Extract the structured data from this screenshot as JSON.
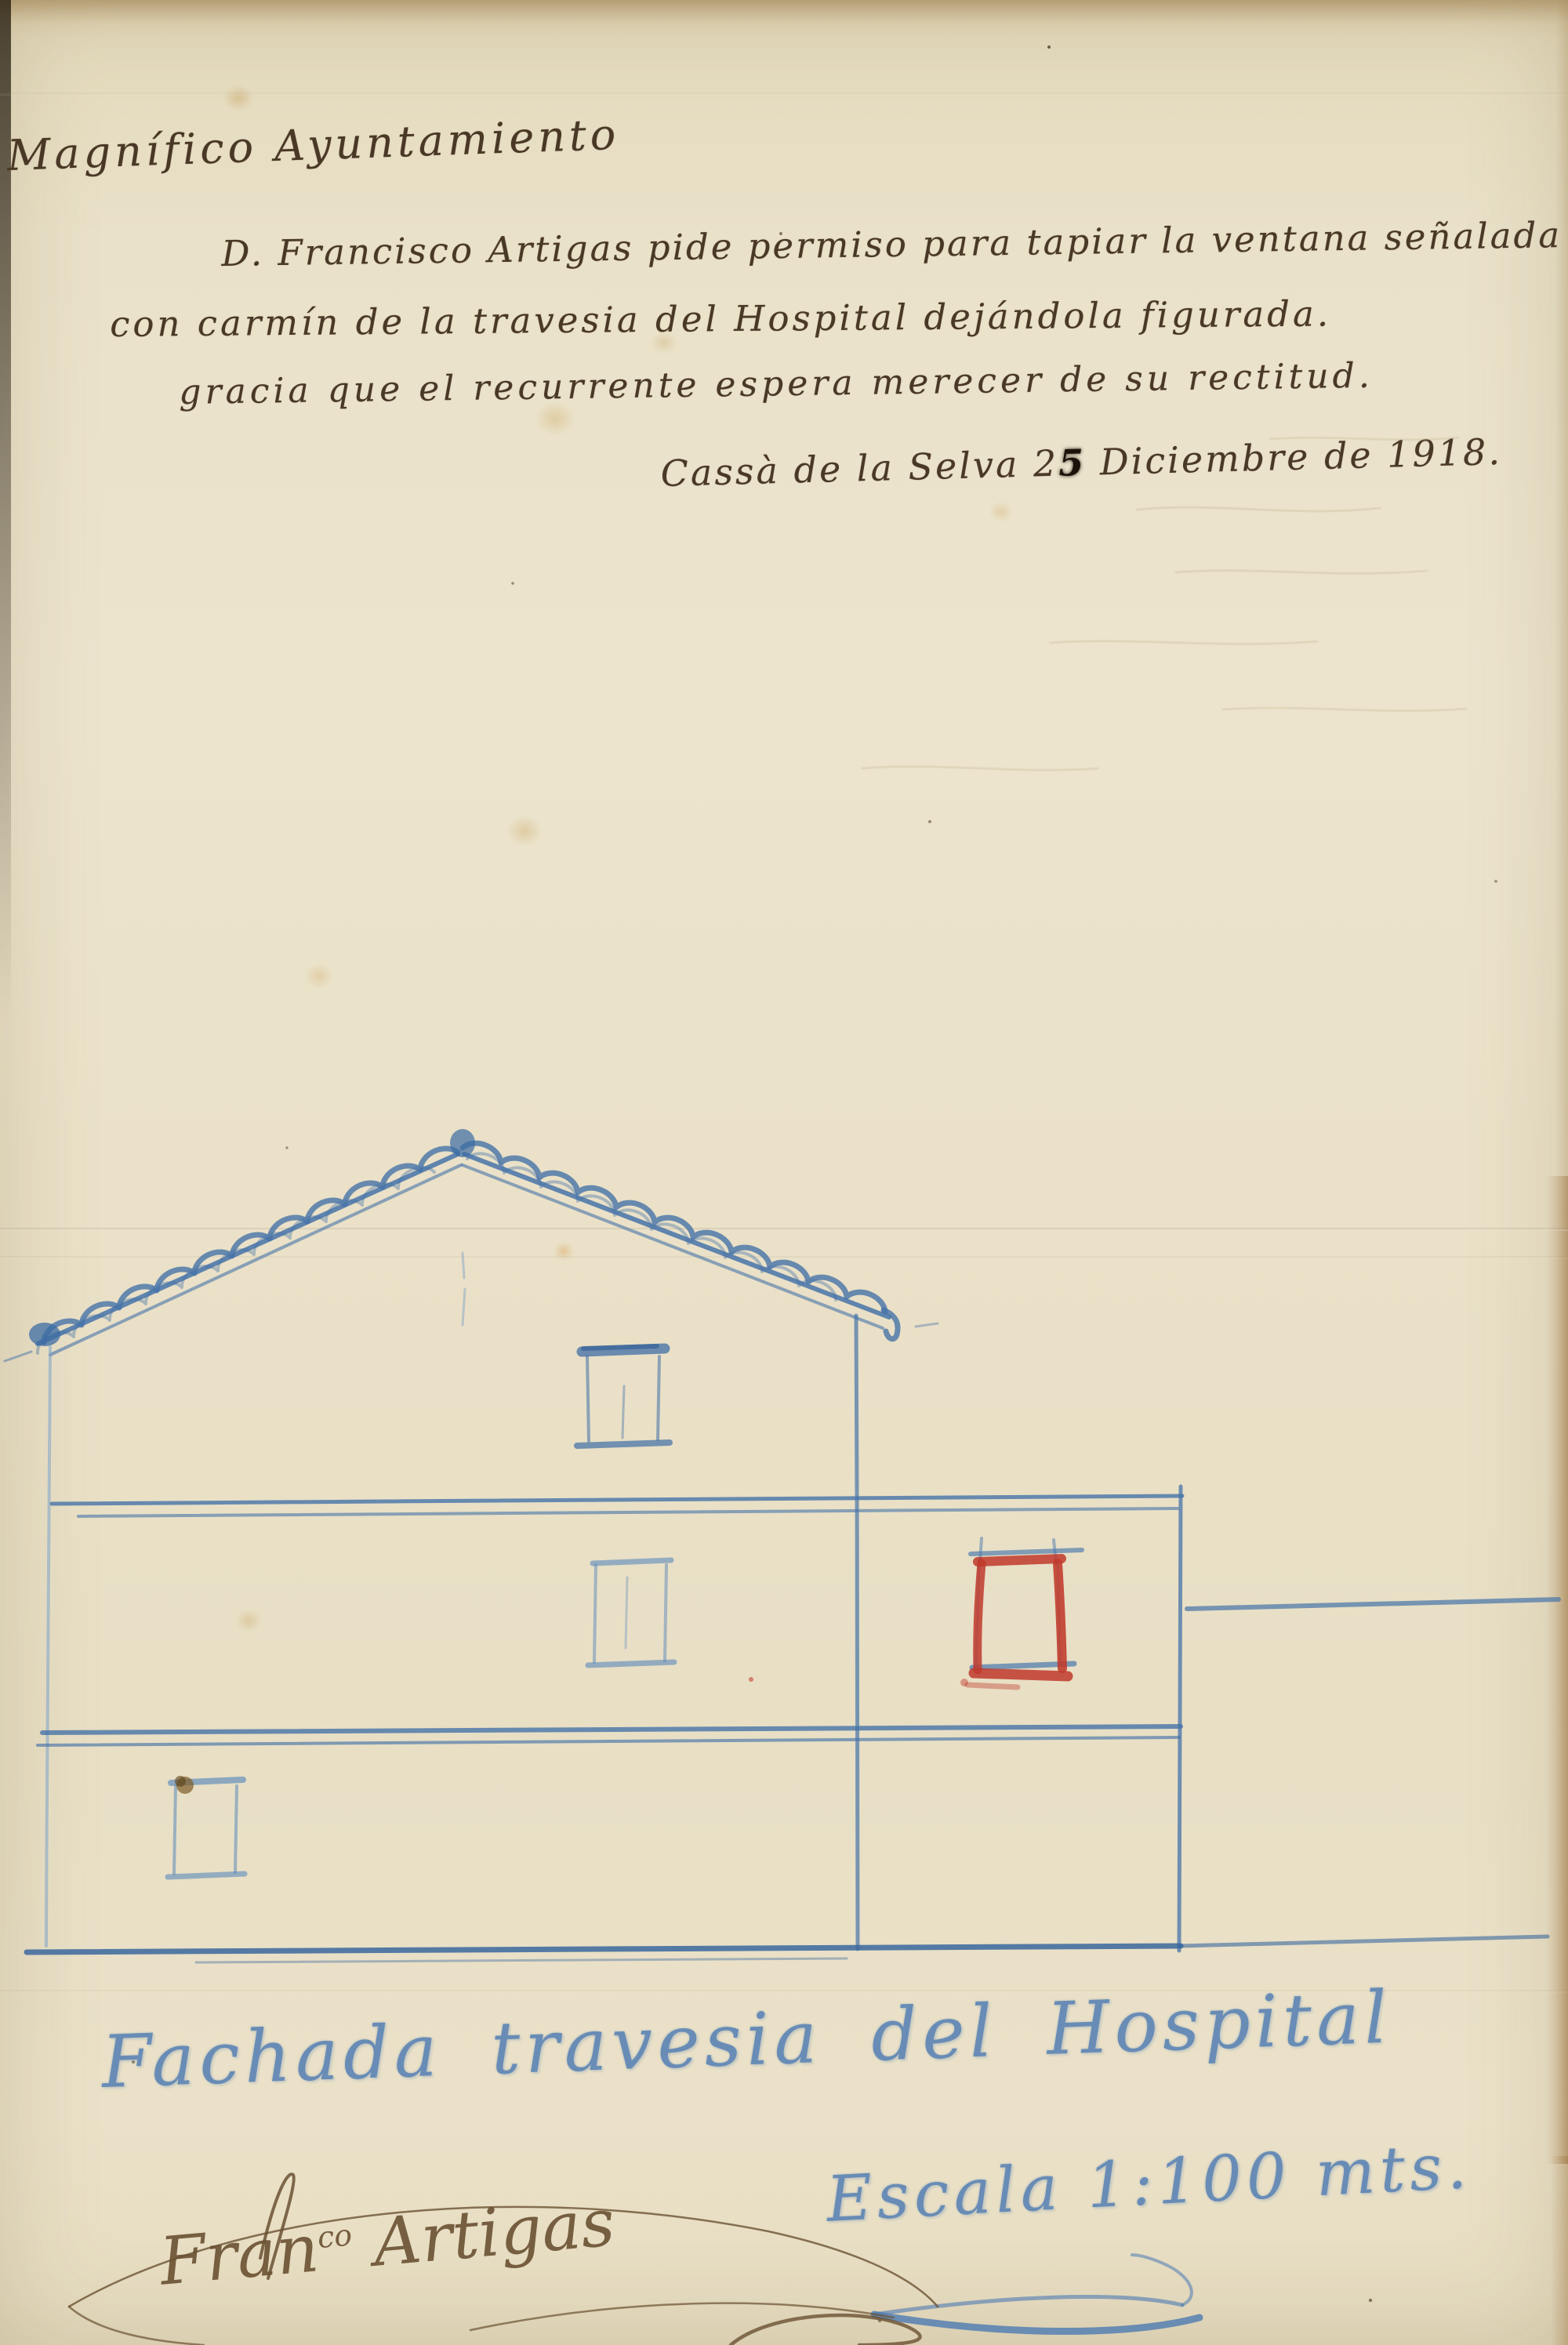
{
  "doc": {
    "heading": "Magnífico Ayuntamiento",
    "petition_line_1": "D. Francisco Artigas pide permiso para tapiar la ventana señalada",
    "petition_line_2": "con carmín de la travesia del Hospital dejándola figurada.",
    "petition_line_3": "gracia que el recurrente espera merecer de su rectitud.",
    "dateline": {
      "pre": "Cassà de la Selva 2",
      "blot": "5",
      "post": " Diciembre de 1918."
    },
    "drawing_caption": "Fachada  travesia del Hospital",
    "scale_note": "Escala 1:100 mts.",
    "signature": {
      "pre": "Fran",
      "sup": "co",
      "post": " Artigas"
    }
  },
  "drawing": {
    "subject": "fachada travesia del Hospital",
    "marked_window_note": "ventana señalada con carmín",
    "colors": {
      "pencil_blue": "#4a76ab",
      "carmine_red": "#c03a2b",
      "ink_brown": "#4a3826",
      "paper_cream": "#e9e0c7"
    }
  }
}
